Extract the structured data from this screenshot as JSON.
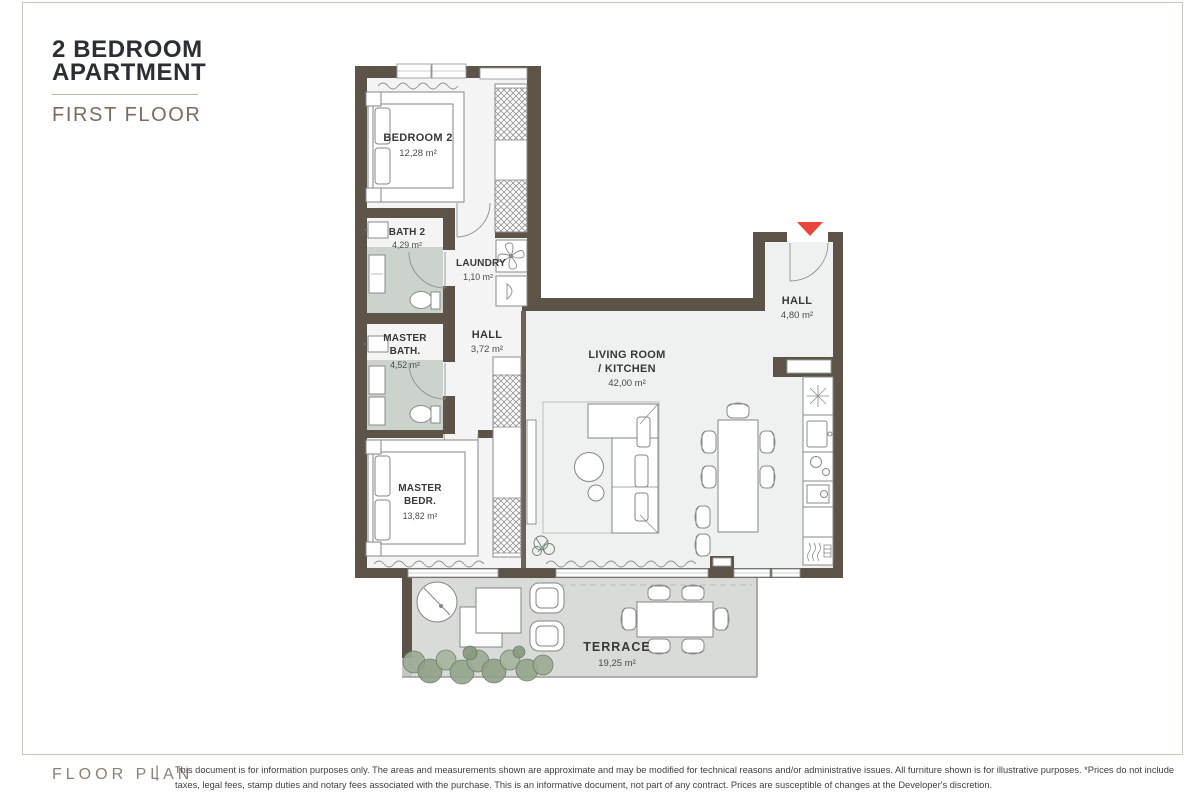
{
  "header": {
    "title_line1": "2 BEDROOM",
    "title_line2": "APARTMENT",
    "subtitle": "FIRST FLOOR"
  },
  "rooms": {
    "bedroom2": {
      "name": "BEDROOM 2",
      "area": "12,28 m²"
    },
    "bath2": {
      "name": "BATH 2",
      "area": "4,29 m²"
    },
    "laundry": {
      "name": "LAUNDRY",
      "area": "1,10 m²"
    },
    "master_bath": {
      "name_line1": "MASTER",
      "name_line2": "BATH.",
      "area": "4,52 m²"
    },
    "hall": {
      "name": "HALL",
      "area": "3,72 m²"
    },
    "living": {
      "name_line1": "LIVING ROOM",
      "name_line2": "/ KITCHEN",
      "area": "42,00 m²"
    },
    "entrance_hall": {
      "name": "HALL",
      "area": "4,80 m²"
    },
    "master_bedroom": {
      "name_line1": "MASTER",
      "name_line2": "BEDR.",
      "area": "13,82 m²"
    },
    "terrace": {
      "name": "TERRACE",
      "area": "19,25 m²"
    }
  },
  "footer": {
    "label": "FLOOR PLAN",
    "separator": "|",
    "disclaimer": "This document is for information purposes only. The areas and measurements shown are approximate and may be modified for technical reasons and/or administrative issues. All furniture shown is for illustrative purposes. *Prices do not include taxes, legal fees, stamp duties and notary fees associated with the purchase. This is an informative document, not part of any contract. Prices are susceptible of changes at the Developer's discretion."
  },
  "colors": {
    "wall": "#5c5349",
    "bath_floor": "#ccd3cd",
    "terrace_floor": "#d9dbd9",
    "interior_floor": "#f0f2f1",
    "accent_red": "#e8453c",
    "border": "#c8c4b9"
  }
}
